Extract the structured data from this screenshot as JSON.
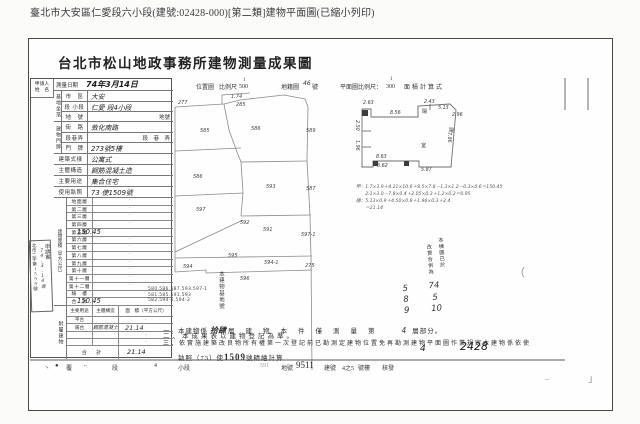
{
  "caption": "臺北市大安區仁愛段六小段(建號:02428-000)[第二類]建物平面圖(已縮小列印)",
  "title": "台北市松山地政事務所建物測量成果圖",
  "header": {
    "location_map": "位置圖",
    "scale_label": "比例尺",
    "location_scale_num": "1",
    "location_scale_den": "500",
    "cadastre_label": "地籍圖",
    "cadastre_no": "46",
    "no_suffix": "號",
    "plan_scale_label": "平面圖比例尺：",
    "plan_scale_num": "1",
    "plan_scale_den": "300",
    "area_calc_label": "面積計算式"
  },
  "form": {
    "applicant_l1": "申請人",
    "applicant_l2": "姓　名",
    "survey_label": "測量日期",
    "survey_value": "74年3月14日",
    "site_group": "基地坐落",
    "site_rows": [
      {
        "label": "市　區",
        "value": "大安",
        "h": 1
      },
      {
        "label": "段 小段",
        "value": "仁愛 段4小段",
        "h": 1
      },
      {
        "label": "地　號",
        "value": "地號",
        "p": 1
      }
    ],
    "addr_group": "建物門牌",
    "addr_rows": [
      {
        "label": "街　路",
        "value": "敦化南路",
        "h": 1
      },
      {
        "label": "段巷弄",
        "value": "段　巷　弄",
        "p": 1
      },
      {
        "label": "門　牌",
        "value": "273號5樓",
        "h": 1
      }
    ],
    "attr_rows": [
      {
        "label": "建築式樣",
        "value": "公寓式",
        "h": 1
      },
      {
        "label": "主體構造",
        "value": "鋼筋混凝土造",
        "h": 1
      },
      {
        "label": "主要用途",
        "value": "集合住宅",
        "h": 1
      },
      {
        "label": "使用執照",
        "value": "73 使1509號",
        "h": 1
      }
    ],
    "floor_group": "建物面積（平方公尺）",
    "floor_rows": [
      {
        "label": "地面層",
        "value": "·"
      },
      {
        "label": "第二層",
        "value": "·"
      },
      {
        "label": "第三層",
        "value": "·"
      },
      {
        "label": "第四層",
        "value": "·"
      },
      {
        "label": "第五層",
        "value": "150.45"
      },
      {
        "label": "第六層",
        "value": "·"
      },
      {
        "label": "第七層",
        "value": "·"
      },
      {
        "label": "第八層",
        "value": "·"
      },
      {
        "label": "第九層",
        "value": "·"
      },
      {
        "label": "第十層",
        "value": "·"
      },
      {
        "label": "第十一層",
        "value": "·"
      },
      {
        "label": "第十二層",
        "value": "·"
      },
      {
        "label": "騎　樓",
        "value": ""
      },
      {
        "label": "合　計",
        "value": "150.45"
      }
    ],
    "annex_group": "附屬建物",
    "annex_headers": [
      "主要用途",
      "主體構造",
      "面　積（平方公尺）"
    ],
    "annex_rows": [
      {
        "use": "平台",
        "structure": "",
        "area": "·"
      },
      {
        "use": "陽台",
        "structure": "鋼筋混凝土",
        "area": "21.14"
      },
      {
        "use": "",
        "structure": "",
        "area": "·"
      },
      {
        "use": "",
        "structure": "",
        "area": "·"
      }
    ],
    "annex_total_label": "合　計",
    "annex_total": "21.14"
  },
  "receipt_stamp": {
    "col1": "申請書",
    "col2": "74.3.14收",
    "col3": "北市二字第1599號"
  },
  "map": {
    "labels": [
      {
        "t": "277",
        "x": 178,
        "y": 100
      },
      {
        "t": "1.74",
        "x": 231,
        "y": 94
      },
      {
        "t": "285",
        "x": 236,
        "y": 102
      },
      {
        "t": "585",
        "x": 200,
        "y": 128
      },
      {
        "t": "586",
        "x": 251,
        "y": 126
      },
      {
        "t": "589",
        "x": 306,
        "y": 128
      },
      {
        "t": "586",
        "x": 193,
        "y": 174
      },
      {
        "t": "593",
        "x": 266,
        "y": 184
      },
      {
        "t": "587",
        "x": 306,
        "y": 186
      },
      {
        "t": "597",
        "x": 196,
        "y": 207
      },
      {
        "t": "592",
        "x": 240,
        "y": 220
      },
      {
        "t": "591",
        "x": 263,
        "y": 227
      },
      {
        "t": "597-1",
        "x": 301,
        "y": 232
      },
      {
        "t": "595",
        "x": 228,
        "y": 253
      },
      {
        "t": "594-1",
        "x": 264,
        "y": 260
      },
      {
        "t": "594",
        "x": 183,
        "y": 264
      },
      {
        "t": "275",
        "x": 305,
        "y": 263
      },
      {
        "t": "596",
        "x": 240,
        "y": 276
      }
    ],
    "lots_label": "本建物基地號",
    "lots": [
      "580.586.587.593.597-1",
      "581.585.591.593",
      "582.594-1.594-2"
    ]
  },
  "plan": {
    "dims": [
      {
        "t": "2.63",
        "x": 363,
        "y": 101
      },
      {
        "t": "8.56",
        "x": 390,
        "y": 111
      },
      {
        "t": "2.43",
        "x": 424,
        "y": 100
      },
      {
        "t": "5.13",
        "x": 438,
        "y": 106
      },
      {
        "t": "2.96",
        "x": 452,
        "y": 113
      },
      {
        "t": "2.50",
        "x": 354,
        "y": 120,
        "v": 1
      },
      {
        "t": "1.96",
        "x": 354,
        "y": 140,
        "v": 1
      },
      {
        "t": "7.86",
        "x": 446,
        "y": 132,
        "v": 1
      },
      {
        "t": "8.63",
        "x": 376,
        "y": 155
      },
      {
        "t": "3.62",
        "x": 377,
        "y": 164
      },
      {
        "t": "5.87",
        "x": 421,
        "y": 168
      },
      {
        "t": "陽",
        "x": 422,
        "y": 108,
        "cjk": 1
      },
      {
        "t": "陽",
        "x": 449,
        "y": 127,
        "cjk": 1
      },
      {
        "t": "室",
        "x": 421,
        "y": 142,
        "cjk": 1
      }
    ],
    "formulas": [
      "甲：1.7×3.9＋4.21×10.6＋8.5×7.8－1.3×1.2－0.3×0.6＝150.45",
      "　　2.1×3.0－7.8×0.4＋2.05×0.3＋1.2×0.2＝0.95",
      "陽：5.13×0.9＋4.50×0.8＋1.96×0.3＋2.4",
      "　　＝21.14"
    ]
  },
  "issue_stamp": {
    "small1": "本棟圖已於",
    "small2": "改算合併為",
    "num": "589",
    "date1": "74",
    "date2": "5",
    "date3": "10"
  },
  "stray_mark": "（",
  "notes": {
    "n1_pre": "一、本建物係",
    "n1_ins": "拾肆",
    "n1_mid": "層建物本件僅測量第",
    "n1_floor": "4",
    "n1_post": "層部分。",
    "n2": "二、本成果表以建物登記為準。",
    "n3": "三、依實施建築改良物所有權第一次登記前已勘測定建物位置免再勘測建物平面圖作業規定本建物係依使",
    "n4_pre": "　　執照（73）使",
    "n4_no": "1509",
    "n4_post": "號精繪計算",
    "hand1": "4",
    "hand2": "2428"
  },
  "footer": {
    "tokens": [
      {
        "t": "丶",
        "x": 44
      },
      {
        "t": "●",
        "x": 55
      },
      {
        "t": "覆",
        "x": 66
      },
      {
        "t": "⌐",
        "x": 84
      },
      {
        "t": "段",
        "x": 112
      },
      {
        "t": "4",
        "x": 154
      },
      {
        "t": "小段",
        "x": 178
      },
      {
        "t": "591",
        "x": 260,
        "faint": 1
      },
      {
        "t": "地號",
        "x": 281
      },
      {
        "t": "9511",
        "x": 296,
        "big": 1
      },
      {
        "t": "建號",
        "x": 324
      },
      {
        "t": "4之5",
        "x": 342
      },
      {
        "t": "號樓",
        "x": 358
      },
      {
        "t": "核發",
        "x": 382
      }
    ],
    "mark1": "–",
    "mark2": "」"
  }
}
